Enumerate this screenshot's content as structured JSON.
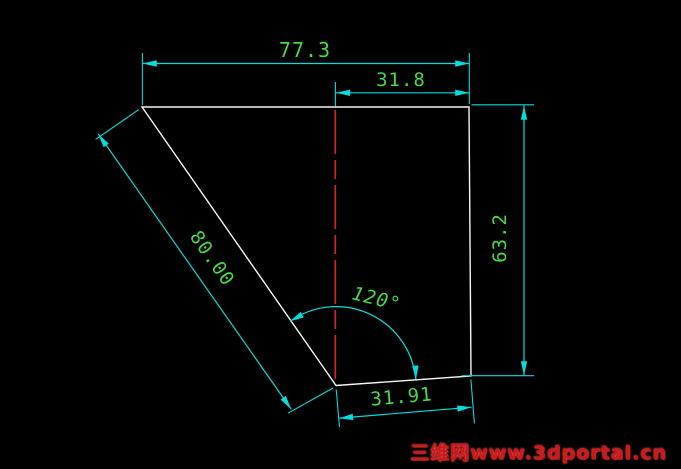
{
  "colors": {
    "background": "#000000",
    "geometry": "#f5f5f5",
    "dimension": "#00dede",
    "dimtext": "#46d846",
    "centerline": "#d22424",
    "watermark": "#d01818",
    "watermarkglow": "#ff6a6a"
  },
  "drawing": {
    "type": "cad-dimensioned-sketch",
    "dims": {
      "top_width": {
        "label": "77.3"
      },
      "upper_right_width": {
        "label": "31.8"
      },
      "right_height": {
        "label": "63.2"
      },
      "diagonal_length": {
        "label": "80.00"
      },
      "angle": {
        "label": "120°"
      },
      "bottom_width": {
        "label": "31.91"
      }
    }
  },
  "watermark": {
    "text": "三维网www.3dportal.cn"
  }
}
